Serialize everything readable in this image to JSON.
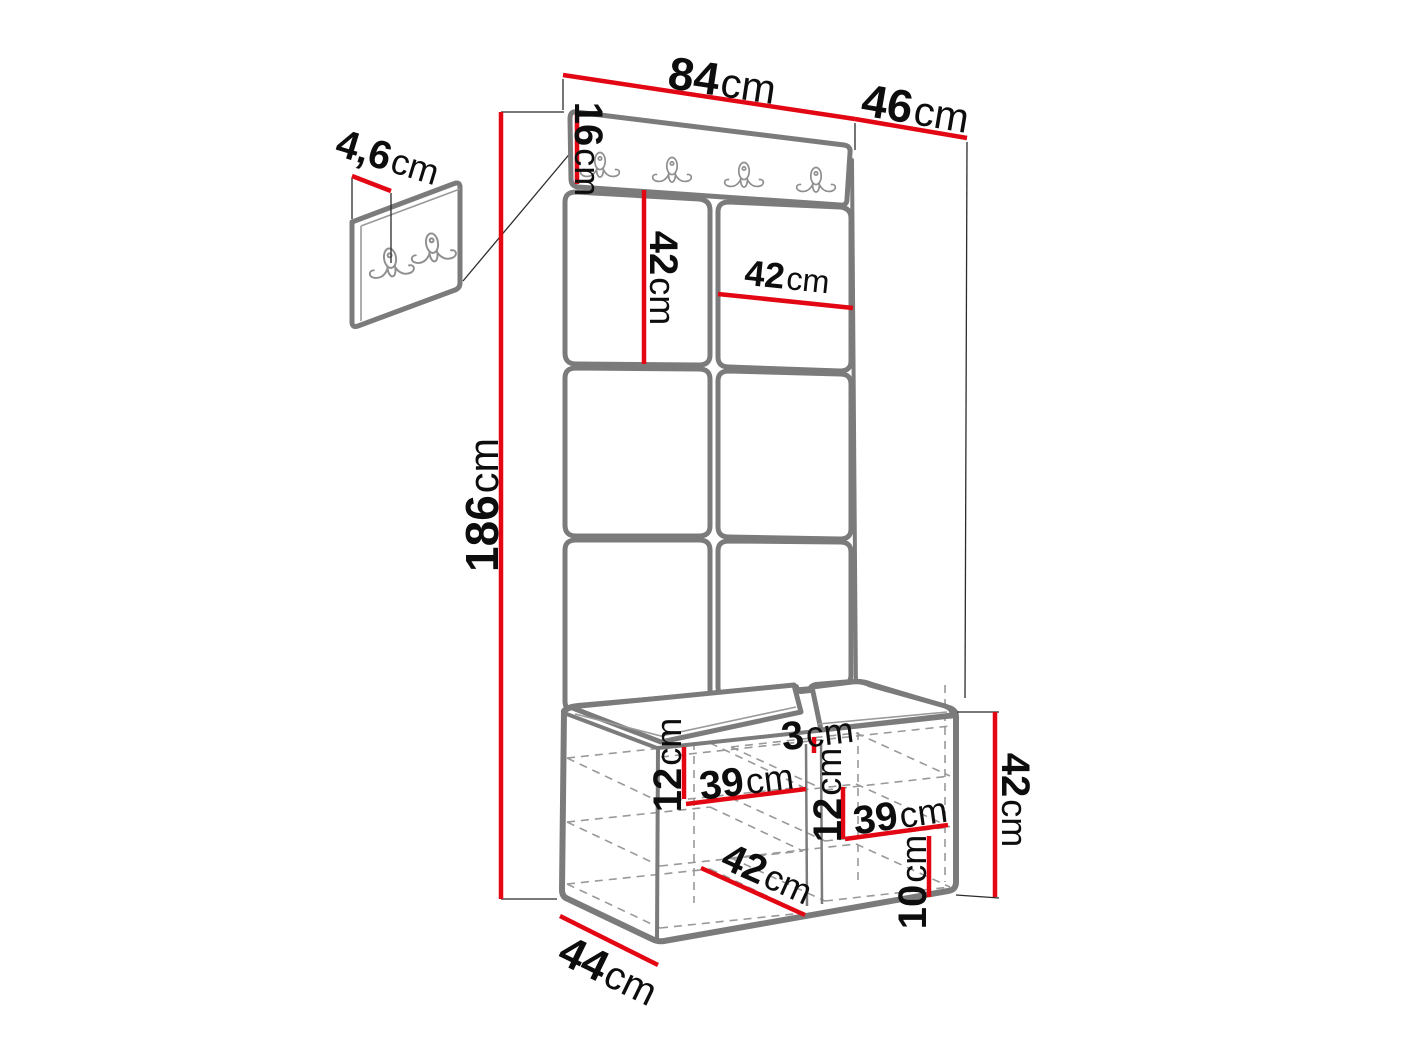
{
  "diagram": {
    "subject": "hallway-furniture-set-dimension-drawing",
    "hooks": {
      "main_rail_hook_count": "4",
      "inset_panel_hook_count": "2"
    },
    "colors": {
      "dimension_line": "#e30613",
      "outline": "#7b7b7b",
      "label_text": "#0d0d0d",
      "background": "#ffffff"
    }
  },
  "dims": {
    "top_width": {
      "value": "84",
      "unit": "cm"
    },
    "top_depth": {
      "value": "46",
      "unit": "cm"
    },
    "rail_height": {
      "value": "16",
      "unit": "cm"
    },
    "inset_thickness": {
      "value": "4,6",
      "unit": "cm"
    },
    "tile_height": {
      "value": "42",
      "unit": "cm"
    },
    "tile_width": {
      "value": "42",
      "unit": "cm"
    },
    "total_height": {
      "value": "186",
      "unit": "cm"
    },
    "cushion_thickness": {
      "value": "3",
      "unit": "cm"
    },
    "shelf_gap_left": {
      "value": "12",
      "unit": "cm"
    },
    "shelf_width_left": {
      "value": "39",
      "unit": "cm"
    },
    "shelf_gap_right": {
      "value": "12",
      "unit": "cm"
    },
    "shelf_width_right": {
      "value": "39",
      "unit": "cm"
    },
    "bench_inner_depth": {
      "value": "42",
      "unit": "cm"
    },
    "bench_height": {
      "value": "42",
      "unit": "cm"
    },
    "plinth_height": {
      "value": "10",
      "unit": "cm"
    },
    "bench_depth": {
      "value": "44",
      "unit": "cm"
    }
  }
}
